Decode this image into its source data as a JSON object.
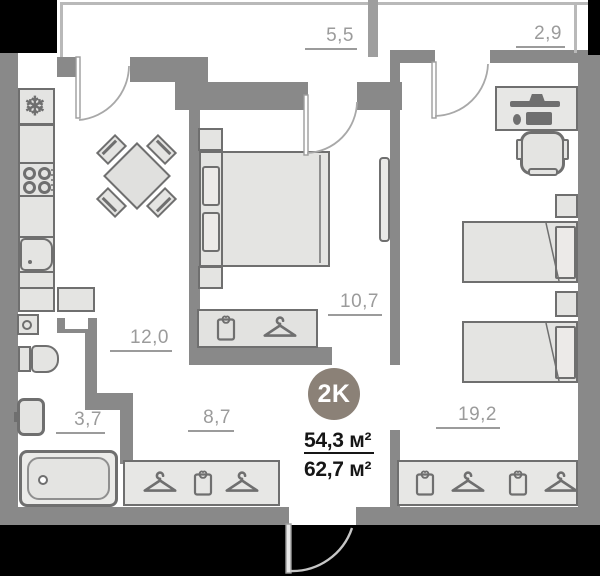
{
  "plan": {
    "badge": {
      "label": "2K",
      "color": "#8b8177"
    },
    "area_summary": {
      "living": "54,3 м²",
      "total": "62,7 м²"
    },
    "rooms": {
      "balcony1": {
        "name": "balcony",
        "area": "5,5"
      },
      "balcony2": {
        "name": "balcony",
        "area": "2,9"
      },
      "kitchen": {
        "name": "kitchen",
        "area": "12,0"
      },
      "bathroom": {
        "name": "bathroom",
        "area": "3,7"
      },
      "hallway": {
        "name": "hallway",
        "area": "8,7"
      },
      "bedroom1": {
        "name": "bedroom",
        "area": "10,7"
      },
      "bedroom2": {
        "name": "bedroom",
        "area": "19,2"
      }
    },
    "icons": {
      "fridge": "❄"
    },
    "colors": {
      "wall": "#898989",
      "outside": "#000000",
      "room_fill": "#ffffff",
      "furniture_fill": "#e4e4e2",
      "furniture_outline": "#6f6f6f",
      "label_text": "#9b9b9b",
      "badge_fill": "#8b8177",
      "summary_text": "#161616"
    }
  }
}
